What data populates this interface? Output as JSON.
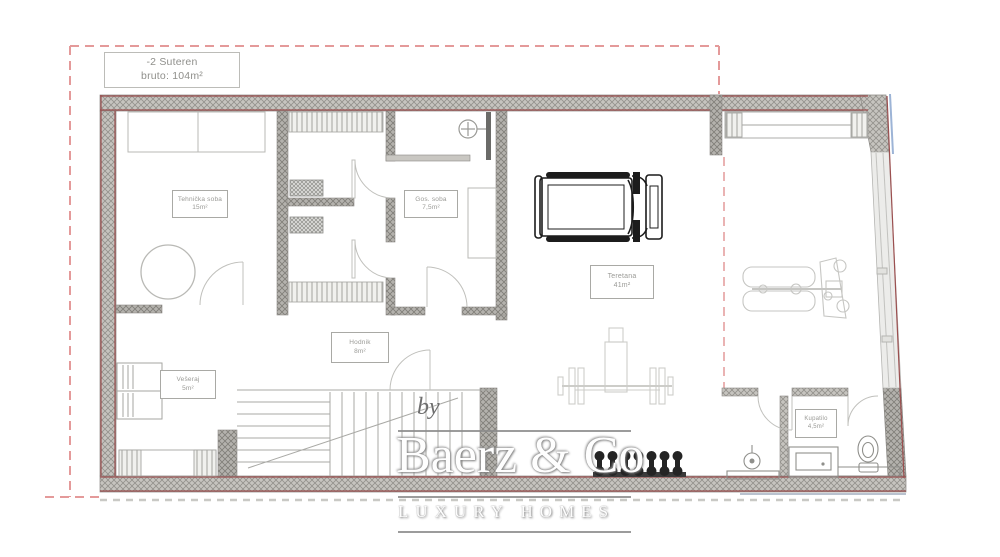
{
  "meta": {
    "level_label_line1": "-2 Suteren",
    "level_label_line2": "bruto: 104m²"
  },
  "rooms": {
    "tehnicka": {
      "name": "Tehnička soba",
      "area": "15m²"
    },
    "gost": {
      "name": "Gos. soba",
      "area": "7,5m²"
    },
    "teretana": {
      "name": "Teretana",
      "area": "41m²"
    },
    "hodnik": {
      "name": "Hodnik",
      "area": "8m²"
    },
    "veseraj": {
      "name": "Vešeraj",
      "area": "5m²"
    },
    "kupatilo": {
      "name": "Kupatilo",
      "area": "4,5m²"
    }
  },
  "watermark": {
    "by": "by",
    "brand": "Baerz & Co",
    "tagline": "LUXURY HOMES"
  },
  "colors": {
    "boundary_dash_red": "#e49a9a",
    "wall_edge_red": "#9b4f4f",
    "wall_fill_gray": "#c6c4bf",
    "fixture_gray": "#bdbdb9",
    "equipment_dark": "#1c1c1c",
    "window_blue": "#9db4d6"
  }
}
